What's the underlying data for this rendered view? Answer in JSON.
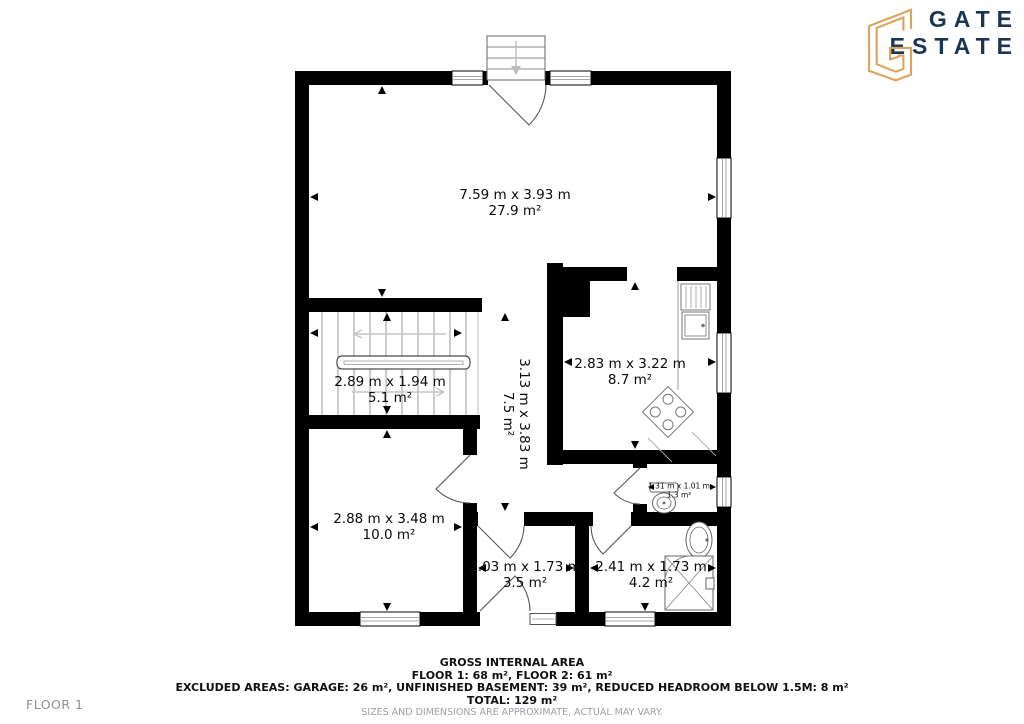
{
  "logo": {
    "brand_line1": "GATE",
    "brand_line2": "ESTATE",
    "icon": "angular-g-monogram",
    "accent_color": "#DBA45C",
    "text_color": "#1C3553"
  },
  "floor_label": "FLOOR 1",
  "rooms": [
    {
      "id": "living-room",
      "dimensions": "7.59 m x 3.93 m",
      "area": "27.9 m²"
    },
    {
      "id": "kitchen",
      "dimensions": "2.83 m x 3.22 m",
      "area": "8.7 m²"
    },
    {
      "id": "staircase",
      "dimensions": "2.89 m x 1.94 m",
      "area": "5.1 m²"
    },
    {
      "id": "hallway",
      "dimensions": "3.13 m x 3.83 m",
      "area": "7.5 m²"
    },
    {
      "id": "room-bottom-left",
      "dimensions": "2.88 m x 3.48 m",
      "area": "10.0 m²"
    },
    {
      "id": "mudroom",
      "dimensions": "2.03 m x 1.73 m",
      "area": "3.5 m²"
    },
    {
      "id": "bathroom",
      "dimensions": "2.41 m x 1.73 m",
      "area": "4.2 m²"
    },
    {
      "id": "wc",
      "dimensions": "1.31 m x 1.01 m",
      "area": "1.3 m²"
    }
  ],
  "footer": {
    "line1": "GROSS INTERNAL AREA",
    "line2": "FLOOR 1: 68 m², FLOOR 2: 61 m²",
    "line3": "EXCLUDED AREAS: GARAGE: 26 m², UNFINISHED BASEMENT: 39 m², REDUCED HEADROOM BELOW 1.5M: 8 m²",
    "line4": "TOTAL: 129 m²",
    "line5": "SIZES AND DIMENSIONS ARE APPROXIMATE, ACTUAL MAY VARY."
  },
  "colors": {
    "walls": "#000000",
    "fixture_lines": "#777777",
    "muted_text": "#9AA0A6"
  }
}
